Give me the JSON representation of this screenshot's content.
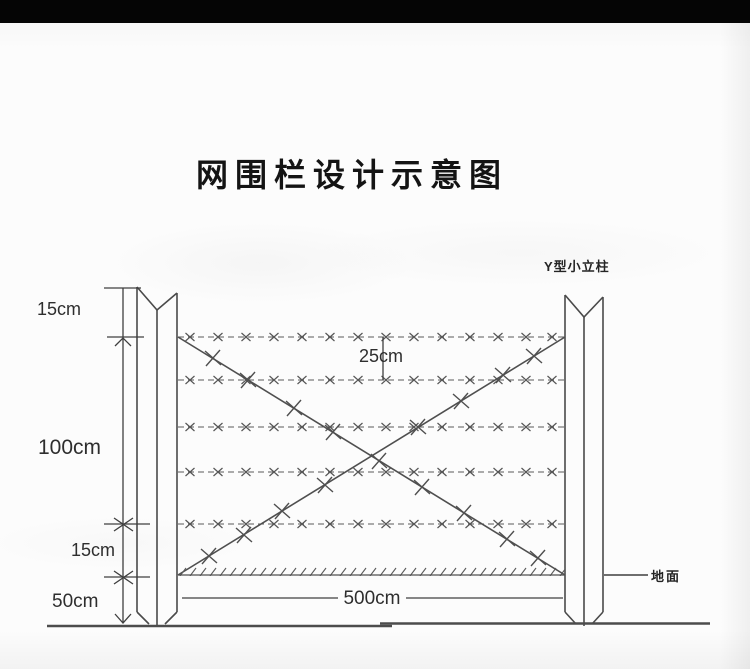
{
  "page": {
    "title": "网围栏设计示意图"
  },
  "diagram": {
    "kind": "fence-design-schematic",
    "labels": {
      "post_type": "Y型小立柱",
      "ground": "地面"
    },
    "dimensions": {
      "post_top_to_first_wire": "15cm",
      "wire_gap": "25cm",
      "fence_body_height": "100cm",
      "last_wire_to_ground": "15cm",
      "buried_depth": "50cm",
      "panel_span": "500cm"
    },
    "structure": {
      "horizontal_wire_count": 5,
      "diagonal_braces": 2,
      "posts": 2
    },
    "colors": {
      "line": "#4f4f4f",
      "text": "#2e2e2e",
      "paper": "#fcfcfc",
      "top_band": "#050505"
    }
  }
}
